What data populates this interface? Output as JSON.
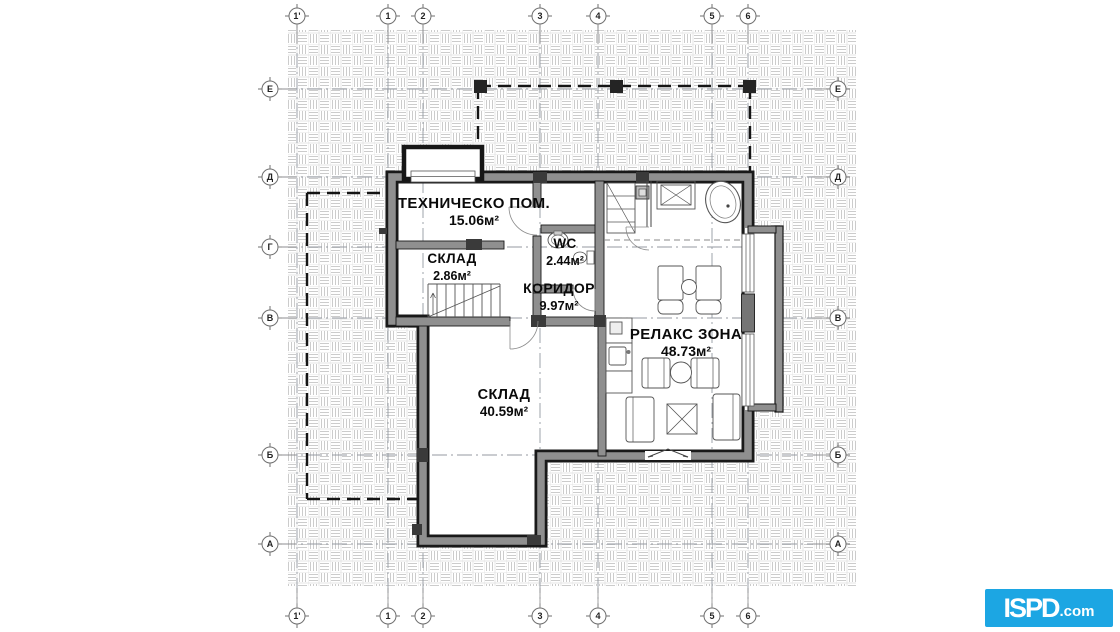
{
  "plan": {
    "rooms": [
      {
        "name": "ТЕХНИЧЕСКО ПОМ.",
        "area": "15.06м²",
        "cx": 474,
        "y": 208,
        "size": 15
      },
      {
        "name": "СКЛАД",
        "area": "2.86м²",
        "cx": 452,
        "y": 263,
        "size": 13.5
      },
      {
        "name": "WC",
        "area": "2.44м²",
        "cx": 565,
        "y": 248,
        "size": 13.5
      },
      {
        "name": "КОРИДОР",
        "area": "9.97м²",
        "cx": 559,
        "y": 293,
        "size": 14
      },
      {
        "name": "РЕЛАКС ЗОНА",
        "area": "48.73м²",
        "cx": 686,
        "y": 339,
        "size": 15
      },
      {
        "name": "СКЛАД",
        "area": "40.59м²",
        "cx": 504,
        "y": 399,
        "size": 14.5
      }
    ],
    "axes": {
      "top": [
        {
          "label": "1'",
          "x": 297
        },
        {
          "label": "1",
          "x": 388
        },
        {
          "label": "2",
          "x": 423
        },
        {
          "label": "3",
          "x": 540
        },
        {
          "label": "4",
          "x": 598
        },
        {
          "label": "5",
          "x": 712
        },
        {
          "label": "6",
          "x": 748
        }
      ],
      "bottom": [
        {
          "label": "1'",
          "x": 297
        },
        {
          "label": "1",
          "x": 388
        },
        {
          "label": "2",
          "x": 423
        },
        {
          "label": "3",
          "x": 540
        },
        {
          "label": "4",
          "x": 598
        },
        {
          "label": "5",
          "x": 712
        },
        {
          "label": "6",
          "x": 748
        }
      ],
      "left": [
        {
          "label": "Е",
          "y": 89
        },
        {
          "label": "Д",
          "y": 177
        },
        {
          "label": "Г",
          "y": 247
        },
        {
          "label": "В",
          "y": 318
        },
        {
          "label": "Б",
          "y": 455
        },
        {
          "label": "А",
          "y": 544
        }
      ],
      "right": [
        {
          "label": "Е",
          "y": 89
        },
        {
          "label": "Д",
          "y": 177
        },
        {
          "label": "В",
          "y": 318
        },
        {
          "label": "Б",
          "y": 455
        },
        {
          "label": "А",
          "y": 544
        }
      ]
    }
  },
  "colors": {
    "wall_fill": "#8f8f8f",
    "wall_edge": "#1a1a1a",
    "hatch_line": "#c9c9c9",
    "grid_line": "#949aa2",
    "label_text": "#0a0a0a",
    "marker_text": "#222222"
  },
  "logo": {
    "text": "ISPD",
    "suffix": ".com",
    "bg": "#1ca6e3",
    "fg": "#ffffff"
  }
}
